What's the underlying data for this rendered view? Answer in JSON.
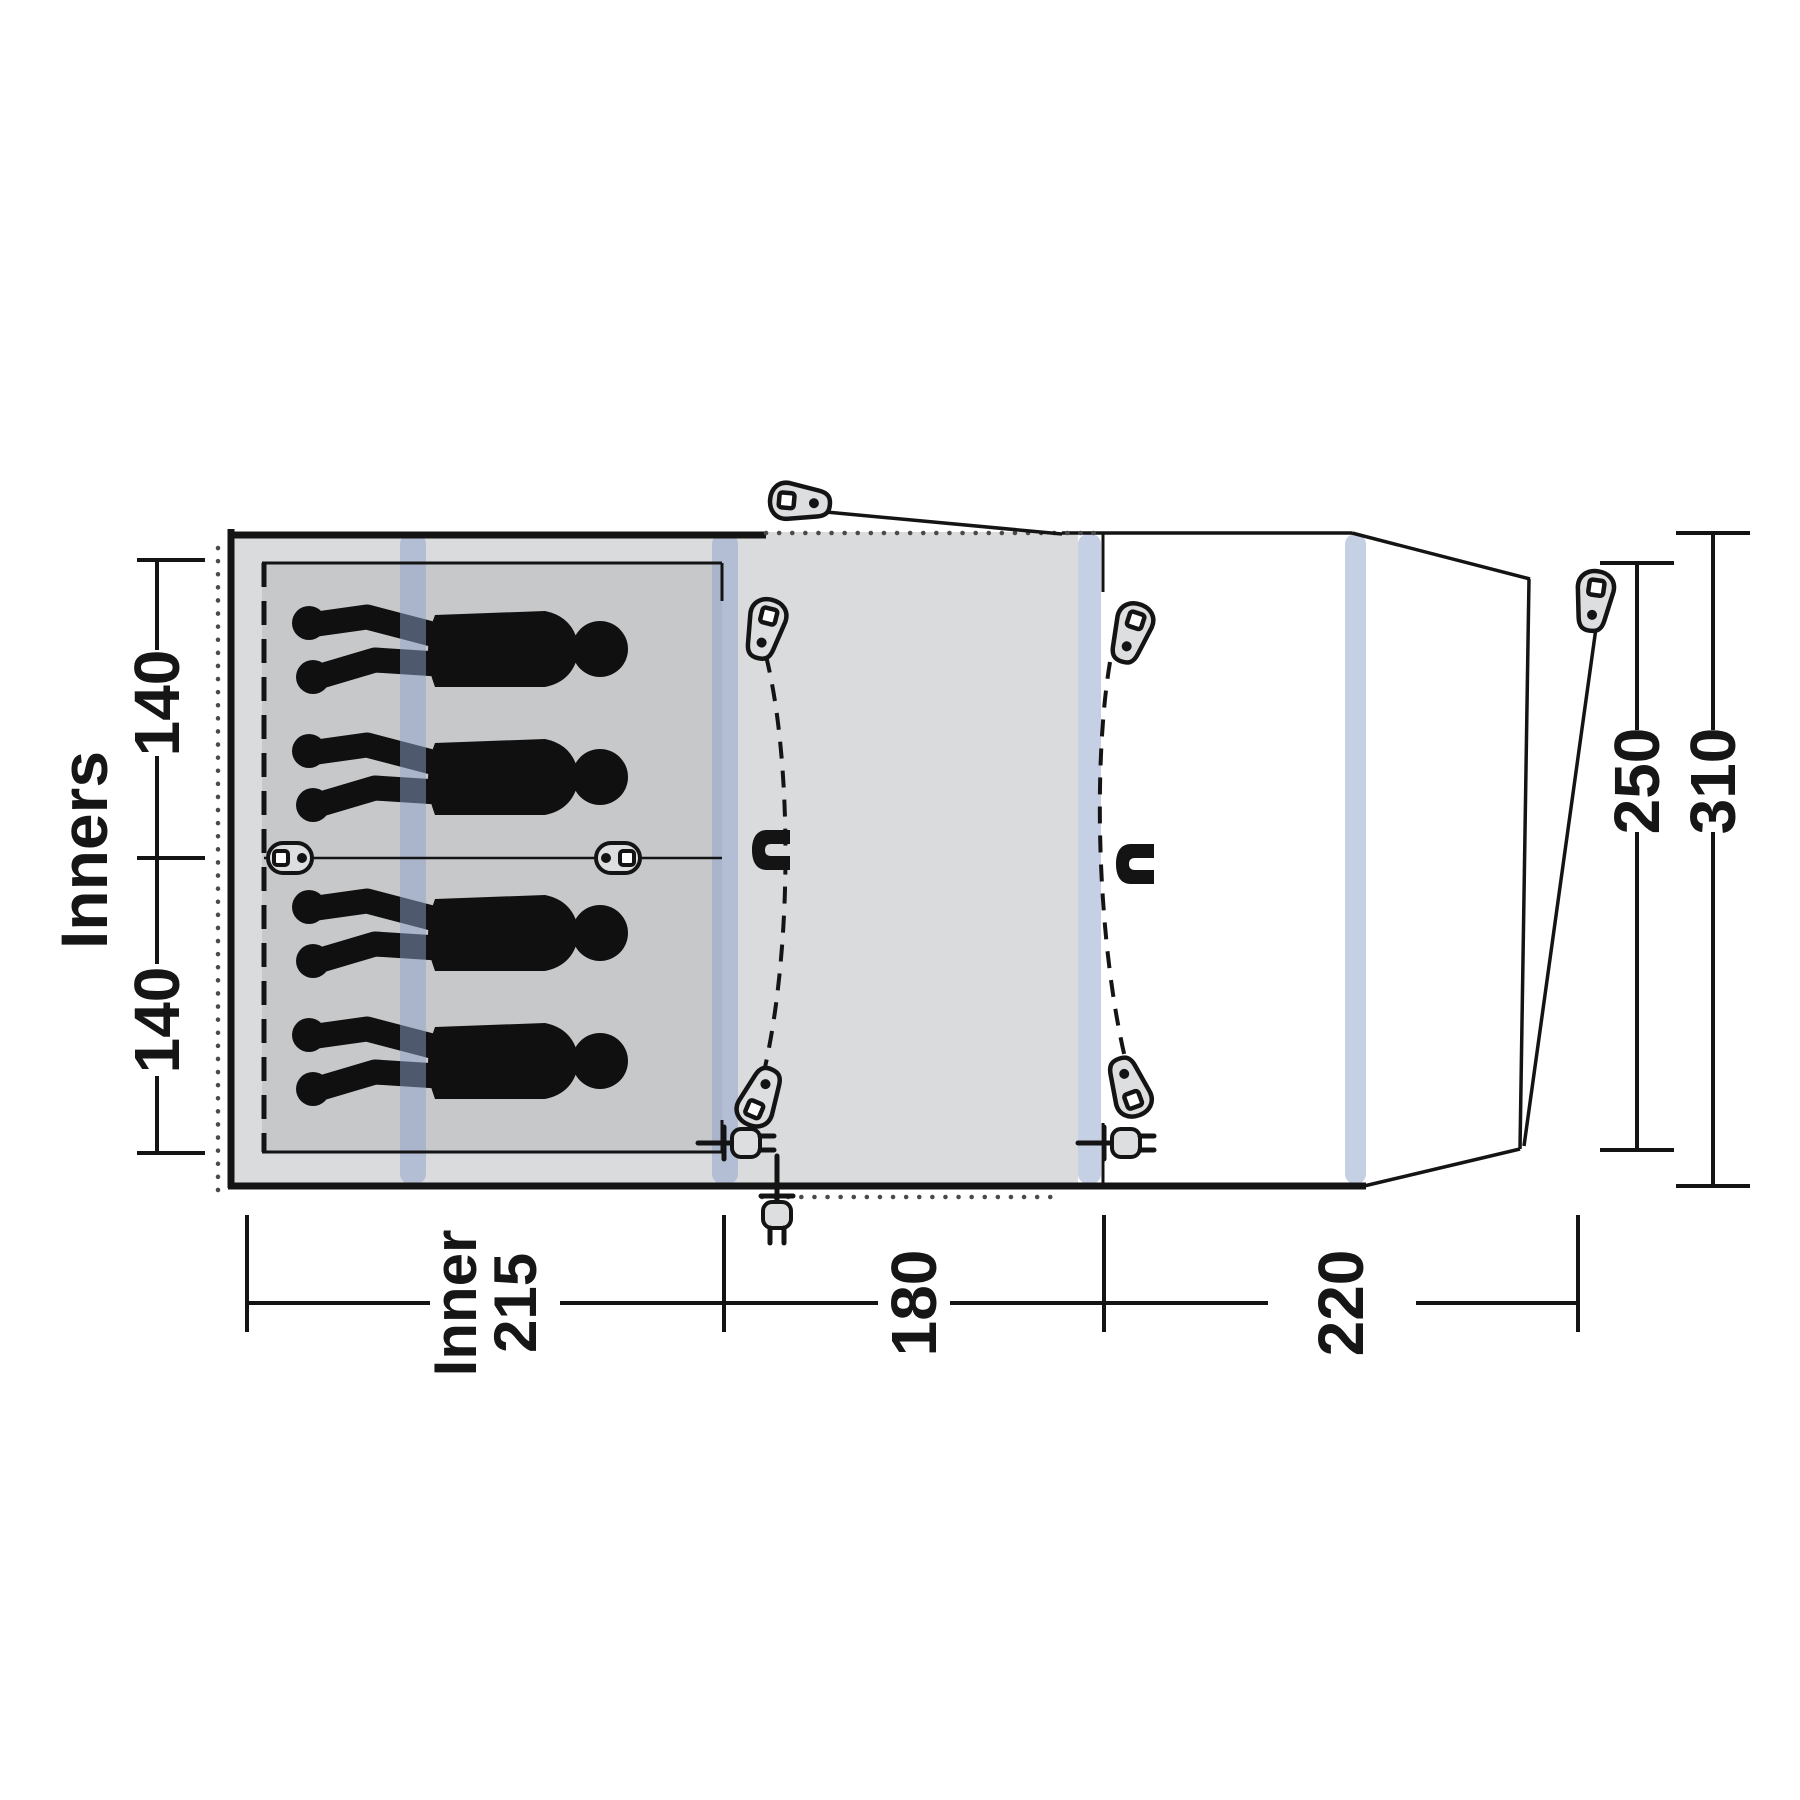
{
  "figure": {
    "kind": "tent floorplan diagram",
    "sleeper_count": 4,
    "colors": {
      "background": "#ffffff",
      "outline": "#141414",
      "canvas_gray": "#d9dbdd",
      "inner_gray": "#c6c8ca",
      "pole_blue": "#8da2cc",
      "icon_fill": "#dcdee0",
      "dotted_line": "#4a4a4a",
      "silhouette": "#101010",
      "text": "#161616"
    },
    "labels": {
      "inners_title": "Inners",
      "inner_bed_top_width": "140",
      "inner_bed_bottom_width": "140",
      "inner_depth_word": "Inner",
      "inner_depth_value": "215",
      "living_depth": "180",
      "porch_depth": "220",
      "front_height": "250",
      "total_width": "310"
    },
    "icons": {
      "zipper_pull": "zipper-pull-icon",
      "magnet": "magnet-tieback-icon",
      "plug": "power-plug-icon",
      "divider_toggle": "cord-toggle-icon",
      "pole": "pole-stripe"
    }
  }
}
